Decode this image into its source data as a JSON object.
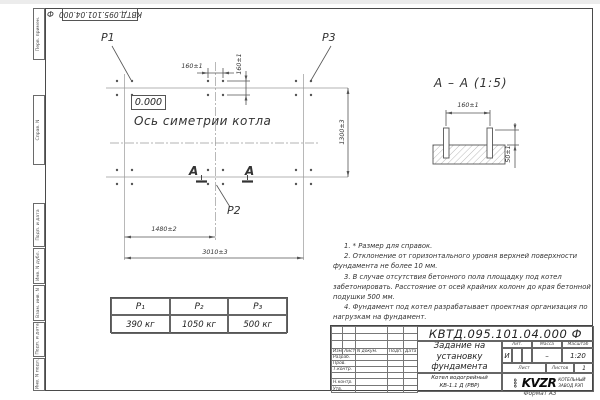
{
  "doc": {
    "code_stamp": "КВТД.095.101.04.000",
    "code_stamp_suffix": "Ф",
    "format_label": "Формат А3"
  },
  "margin_labels": {
    "perv_primen": "Перв. примен.",
    "sprav_n": "Справ. N",
    "podp_data_1": "Подп. и дата",
    "inv_dubl": "Инв. N дубл.",
    "vzam_inv": "Взам. инв. N",
    "podp_data_2": "Подп. и дата",
    "inv_podl": "Инв. N подл."
  },
  "plan": {
    "p1_label": "P1",
    "p2_label": "P2",
    "p3_label": "P3",
    "elevation_mark": "0.000",
    "axis_caption": "Ось симетрии котла",
    "section_letter_left": "А",
    "section_letter_right": "А",
    "dim_bolt_spacing_h": "160±1",
    "dim_bolt_spacing_v": "160±1",
    "dim_half_span": "1480±2",
    "dim_full_span": "3010±3",
    "dim_depth": "1300±3"
  },
  "section_view": {
    "title": "А – А (1:5)",
    "dim_width": "160±1",
    "dim_height": "50±1"
  },
  "notes": [
    "1. * Размер для справок.",
    "2. Отклонение от горизонтального уровня верхней поверхности фундамента не более 10 мм.",
    "3. В случае отсутствия бетонного пола площадку под котел забетонировать. Расстояние от осей крайних колонн до края бетонной подушки 500 мм.",
    "4. Фундамент под котел разрабатывает проектная организация по нагрузкам на фундамент."
  ],
  "loads_table": {
    "headers": [
      "P₁",
      "P₂",
      "P₃"
    ],
    "values": [
      "390 кг",
      "1050 кг",
      "500 кг"
    ]
  },
  "title_block": {
    "doc_number": "КВТД.095.101.04.000  Ф",
    "title": "Задание на установку фундамента",
    "subtitle_line1": "Котел водогрейный",
    "subtitle_line2": "КВ-1.1 Д  (РВР)",
    "col_izm": "Изм.",
    "col_list": "Лист",
    "col_docnum": "N докум.",
    "col_podp": "Подп.",
    "col_data": "Дата",
    "row_razrab": "Разраб.",
    "row_prov": "Пров.",
    "row_tkontr": "Т.контр.",
    "row_nkontr": "Н.контр.",
    "row_utv": "Утв.",
    "lit_label": "Лит.",
    "lit_value": "И",
    "massa_label": "Масса",
    "massa_value": "–",
    "masshtab_label": "Масштаб",
    "masshtab_value": "1:20",
    "list_label": "Лист",
    "listov_label": "Листов",
    "listov_value": "1",
    "logo_ooo": "ООО",
    "logo_text": "KVZR",
    "logo_caption_line1": "КОТЕЛЬНЫЙ",
    "logo_caption_line2": "ЗАВОД РЭП"
  }
}
